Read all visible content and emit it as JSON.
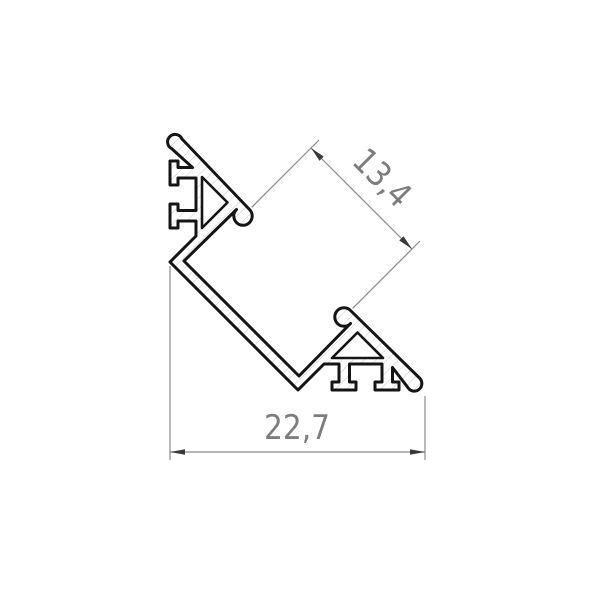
{
  "drawing": {
    "dimensions": {
      "diagonal_label": "13,4",
      "width_label": "22,7"
    }
  },
  "colors": {
    "background": "#ffffff",
    "outline": "#151515",
    "body_fill": "#ffffff",
    "hatch": "#c9c9c9",
    "dimension_line": "#8a8a8a",
    "arrow": "#3a3a3a",
    "label": "#7d7d7d"
  }
}
